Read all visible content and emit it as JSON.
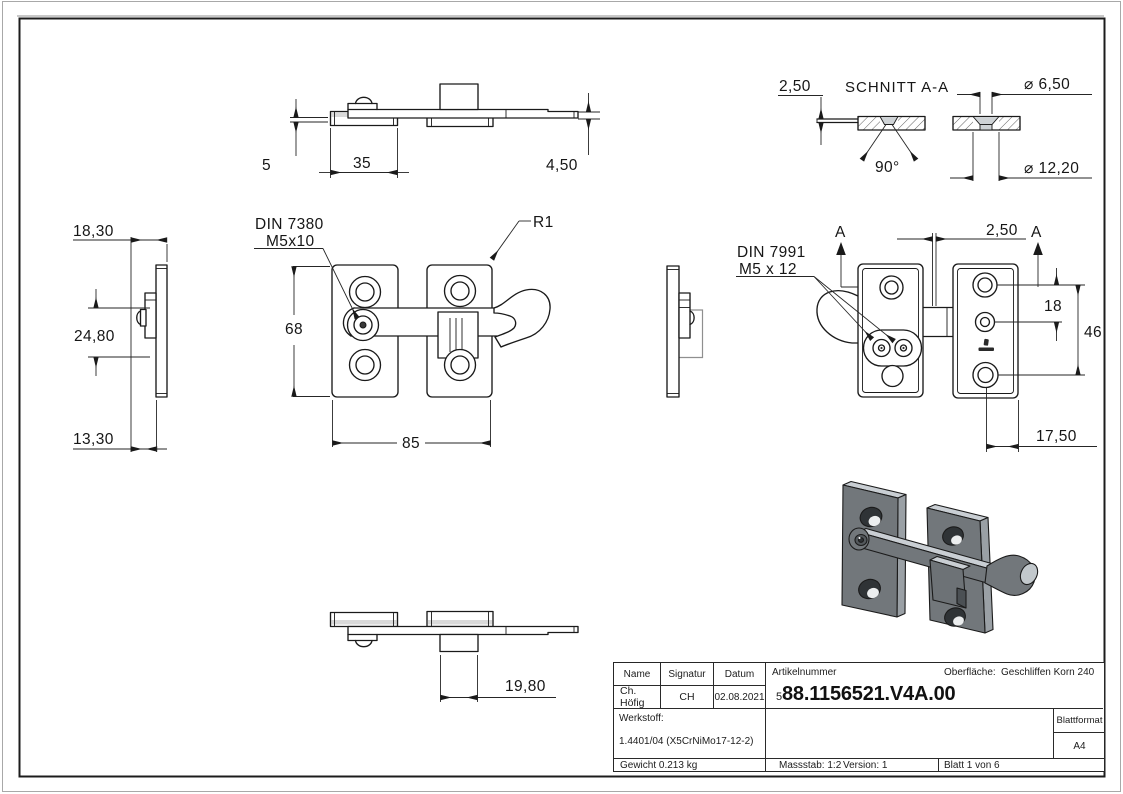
{
  "views": {
    "top": {
      "dim_thickness": "5",
      "dim_width": "35",
      "dim_height": "4,50"
    },
    "section": {
      "title": "SCHNITT A-A",
      "dim_thickness": "2,50",
      "dim_hole_small": "⌀ 6,50",
      "dim_angle": "90°",
      "dim_hole_large": "⌀ 12,20"
    },
    "side": {
      "dim_depth": "18,30",
      "dim_handle": "24,80",
      "dim_plate": "13,30"
    },
    "front": {
      "note_screw": "DIN 7380",
      "note_screw_size": "M5x10",
      "note_radius": "R1",
      "dim_height": "68",
      "dim_width": "85"
    },
    "rear": {
      "note_screw": "DIN 7991",
      "note_screw_size": "M5 x 12",
      "section_label": "A",
      "dim_offset": "2,50",
      "dim_hole_top": "18",
      "dim_hole_span": "46",
      "dim_edge": "17,50"
    },
    "bottom": {
      "dim_block": "19,80"
    }
  },
  "title_block": {
    "name_label": "Name",
    "signature_label": "Signatur",
    "date_label": "Datum",
    "name_value": "Ch. Höfig",
    "signature_value": "CH",
    "date_value": "02.08.2021",
    "article_label": "Artikelnummer",
    "article_prefix": "5",
    "article_number": "88.1156521.V4A.00",
    "surface_label": "Oberfläche:",
    "surface_value": "Geschliffen Korn 240",
    "material_label": "Werkstoff:",
    "material_value": "1.4401/04 (X5CrNiMo17-12-2)",
    "weight_value": "Gewicht 0.213 kg",
    "scale_value": "Massstab: 1:2",
    "version_value": "Version: 1",
    "sheet_value": "Blatt 1 von 6",
    "format_label": "Blattformat",
    "format_value": "A4"
  }
}
